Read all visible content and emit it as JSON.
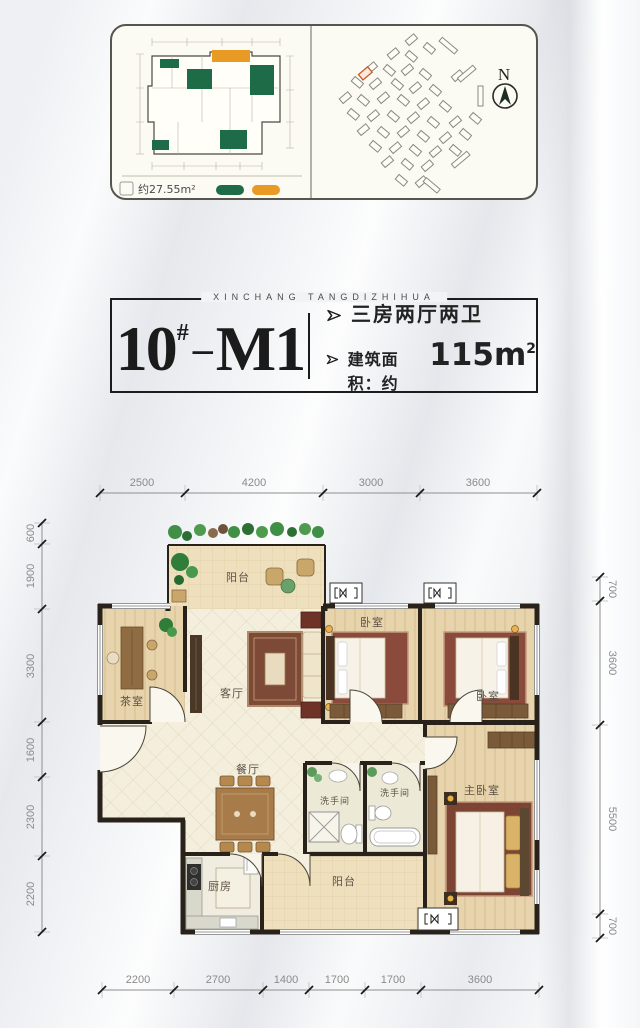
{
  "summary_panel": {
    "mini_plan": {
      "area_label": "约27.55m²",
      "legend": [
        {
          "name": "green-swatch",
          "color": "#1d6b47"
        },
        {
          "name": "orange-swatch",
          "color": "#e89a25"
        }
      ]
    },
    "site_plan": {
      "north_label": "N",
      "highlight_color": "#cc5a22"
    }
  },
  "title_block": {
    "subtitle": "XINCHANG TANGDIZHIHUA",
    "unit_number": "10",
    "unit_superscript": "#",
    "separator": "–",
    "unit_model": "M1",
    "feature_1": "三房两厅两卫",
    "feature_2_prefix": "建筑面积：约",
    "feature_2_value": "115m",
    "feature_2_sup": "2"
  },
  "floor_plan": {
    "rooms": [
      {
        "name": "balcony-top",
        "label": "阳台"
      },
      {
        "name": "tea-room",
        "label": "茶室"
      },
      {
        "name": "living-room",
        "label": "客厅"
      },
      {
        "name": "bedroom-1",
        "label": "卧室"
      },
      {
        "name": "bedroom-2",
        "label": "卧室"
      },
      {
        "name": "dining-room",
        "label": "餐厅"
      },
      {
        "name": "bathroom-1",
        "label": "洗手间"
      },
      {
        "name": "bathroom-2",
        "label": "洗手间"
      },
      {
        "name": "master-bedroom",
        "label": "主卧室"
      },
      {
        "name": "kitchen",
        "label": "厨房"
      },
      {
        "name": "balcony-bottom",
        "label": "阳台"
      }
    ],
    "dims_top": [
      "2500",
      "4200",
      "3000",
      "3600"
    ],
    "dims_bottom": [
      "2200",
      "2700",
      "1400",
      "1700",
      "1700",
      "3600"
    ],
    "dims_left": [
      "600",
      "1900",
      "3300",
      "1600",
      "2300",
      "2200"
    ],
    "dims_right": [
      "700",
      "3600",
      "5500",
      "700"
    ]
  }
}
